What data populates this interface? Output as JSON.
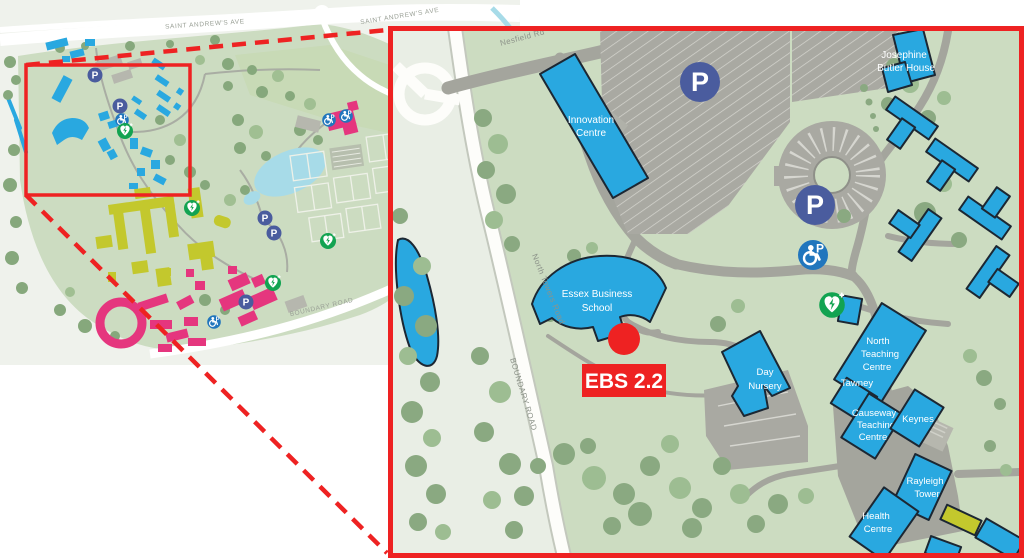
{
  "figure": {
    "description_label": "Campus map with zoom callout"
  },
  "colors": {
    "red": "#ee2222",
    "building_blue": "#29a8e0",
    "building_yellow": "#c3c82d",
    "building_pink": "#e5367e",
    "parking_navy": "#4a5c9e",
    "accessible_blue": "#2176bd",
    "defib_green": "#12a351",
    "lake_blue": "#a7dbe8",
    "campus_green": "#ccdcc1",
    "road_label_gray": "#8d938a"
  },
  "overview_map": {
    "road_labels": {
      "saint_andrews_ave": "SAINT ANDREW'S AVE",
      "boundary_road": "BOUNDARY ROAD"
    },
    "icons": {
      "parking": "P"
    }
  },
  "detail_map": {
    "road_labels": {
      "nesfield_rd": "Nesfield Rd",
      "north_towers_road": "North Towers Road",
      "boundary_road": "BOUNDARY ROAD"
    },
    "buildings": {
      "innovation_centre": [
        "Innovation",
        "Centre"
      ],
      "josephine_butler_house": [
        "Josephine",
        "Butler House"
      ],
      "essex_business_school": [
        "Essex Business",
        "School"
      ],
      "day_nursery": [
        "Day",
        "Nursery"
      ],
      "north_teaching_centre": [
        "North",
        "Teaching",
        "Centre"
      ],
      "tawney": [
        "Tawney"
      ],
      "causeway_teaching_centre": [
        "Causeway",
        "Teaching",
        "Centre"
      ],
      "keynes": [
        "Keynes"
      ],
      "rayleigh_tower": [
        "Rayleigh",
        "Tower"
      ],
      "health_centre": [
        "Health",
        "Centre"
      ]
    },
    "marker": {
      "label": "EBS 2.2"
    },
    "icons": {
      "parking": "P"
    }
  }
}
